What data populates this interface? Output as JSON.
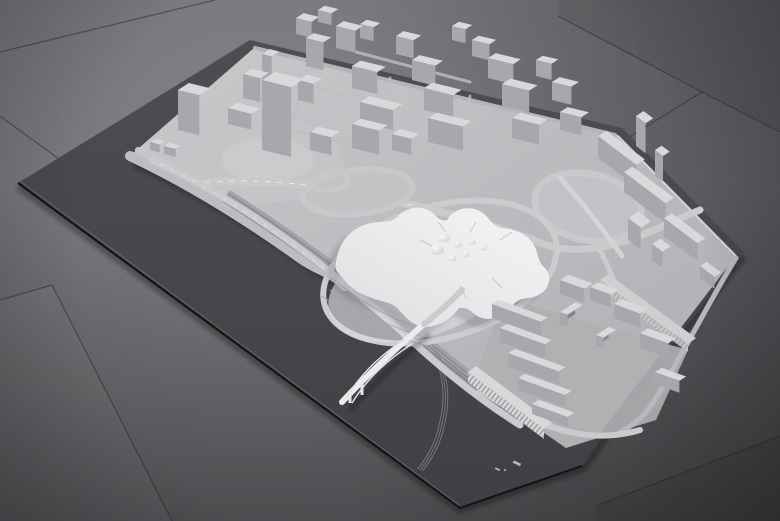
{
  "meta": {
    "title": "Photograph of a white architectural urban-planning scale model on dark grey base boards, standing on large grey floor tiles",
    "type": "photograph",
    "visible_text": "none"
  },
  "scene": {
    "elements": [
      "grey tiled floor with diagonal seams",
      "dark grey model base board representing river and context",
      "white terrain platform with road network",
      "dense cluster of rectangular buildings (north)",
      "tall slab tower in north cluster",
      "large organic star-shaped building with dome skylights (center)",
      "two highway interchanges with loop ramps",
      "arched bridge crossing the dark river band",
      "curved viaduct crossing the river at the west tip",
      "railway tracks running along the river bank",
      "rows of parallel slab buildings (southeast)",
      "long striped-facade building along the quay",
      "slab buildings and small towers along the east edge",
      "tiny light scale marks on the base board edge"
    ]
  },
  "palette": {
    "floor_base": "#6e6c71",
    "floor_dark": "#3f4143",
    "board_top": "#4c4e51",
    "board_bottom": "#3e4043",
    "board_edge": "#141517",
    "terrain_light": "#c9c9cc",
    "terrain_dark": "#aeaeb2",
    "road": "#cbcbce",
    "road_marking": "#f2f2f3",
    "building_top": "#d9d9db",
    "building_front": "#a7a8ac",
    "building_side": "#85868a",
    "roof_white": "#f5f5f7",
    "roof_shade": "#dfdfe2",
    "bank": "#9fa0a4",
    "track": "#7e7f83",
    "bridge": "#ececee",
    "shadow": "rgba(40,42,46,0.28)",
    "seam": "rgba(30,31,34,0.45)"
  },
  "districts": [
    {
      "id": "g-north",
      "name": "north-cluster",
      "u": [
        0.972,
        0.236
      ],
      "v": [
        0.841,
        -0.541
      ],
      "buildings": [
        [
          150,
          150,
          10,
          6,
          8
        ],
        [
          164,
          154,
          12,
          6,
          8
        ],
        [
          296,
          34,
          16,
          9,
          16
        ],
        [
          318,
          22,
          14,
          8,
          12
        ],
        [
          336,
          48,
          20,
          9,
          22
        ],
        [
          360,
          38,
          14,
          8,
          14
        ],
        [
          396,
          54,
          18,
          9,
          18
        ],
        [
          452,
          40,
          14,
          8,
          14
        ],
        [
          472,
          56,
          18,
          8,
          16
        ],
        [
          306,
          66,
          18,
          9,
          28
        ],
        [
          262,
          84,
          10,
          9,
          30
        ],
        [
          352,
          88,
          26,
          10,
          22
        ],
        [
          412,
          80,
          24,
          9,
          20
        ],
        [
          488,
          78,
          26,
          9,
          20
        ],
        [
          536,
          76,
          16,
          8,
          16
        ],
        [
          243,
          98,
          18,
          10,
          24
        ],
        [
          298,
          100,
          16,
          10,
          20
        ],
        [
          424,
          110,
          30,
          10,
          22
        ],
        [
          502,
          106,
          28,
          10,
          22
        ],
        [
          552,
          100,
          20,
          9,
          18
        ],
        [
          228,
          124,
          24,
          10,
          16
        ],
        [
          360,
          122,
          34,
          11,
          20
        ],
        [
          178,
          130,
          22,
          13,
          40
        ],
        [
          428,
          142,
          36,
          10,
          24
        ],
        [
          512,
          138,
          28,
          10,
          20
        ],
        [
          262,
          150,
          30,
          15,
          70
        ],
        [
          352,
          148,
          28,
          10,
          24
        ],
        [
          560,
          130,
          22,
          9,
          18
        ],
        [
          310,
          150,
          22,
          10,
          18
        ],
        [
          392,
          150,
          20,
          9,
          16
        ]
      ]
    },
    {
      "id": "g-east",
      "name": "east-edge",
      "u": [
        0.8,
        0.6
      ],
      "v": [
        0.841,
        -0.541
      ],
      "buildings": [
        [
          636,
          146,
          12,
          9,
          30
        ],
        [
          598,
          158,
          48,
          10,
          22
        ],
        [
          655,
          176,
          10,
          8,
          26
        ],
        [
          624,
          192,
          52,
          10,
          20
        ],
        [
          664,
          236,
          42,
          9,
          18
        ],
        [
          628,
          240,
          16,
          12,
          22
        ],
        [
          652,
          260,
          13,
          10,
          16
        ],
        [
          700,
          278,
          18,
          8,
          12
        ]
      ]
    },
    {
      "id": "g-se",
      "name": "southeast-rows",
      "u": [
        0.94,
        0.34
      ],
      "v": [
        0.841,
        -0.541
      ],
      "buildings": [
        [
          560,
          294,
          26,
          10,
          14
        ],
        [
          590,
          300,
          22,
          9,
          13
        ],
        [
          492,
          318,
          52,
          8,
          14
        ],
        [
          614,
          318,
          28,
          9,
          14
        ],
        [
          560,
          324,
          8,
          18,
          12
        ],
        [
          500,
          342,
          48,
          8,
          14
        ],
        [
          640,
          348,
          30,
          9,
          15
        ],
        [
          596,
          346,
          8,
          15,
          11
        ],
        [
          508,
          366,
          54,
          8,
          13
        ],
        [
          518,
          390,
          50,
          8,
          12
        ],
        [
          655,
          384,
          26,
          8,
          12
        ],
        [
          532,
          414,
          38,
          8,
          10
        ]
      ]
    }
  ],
  "base_marks": {
    "description": "two small light dashes and a dot (model maker marks / scale bar) on the dark base board near its lower edge",
    "count": 3
  }
}
